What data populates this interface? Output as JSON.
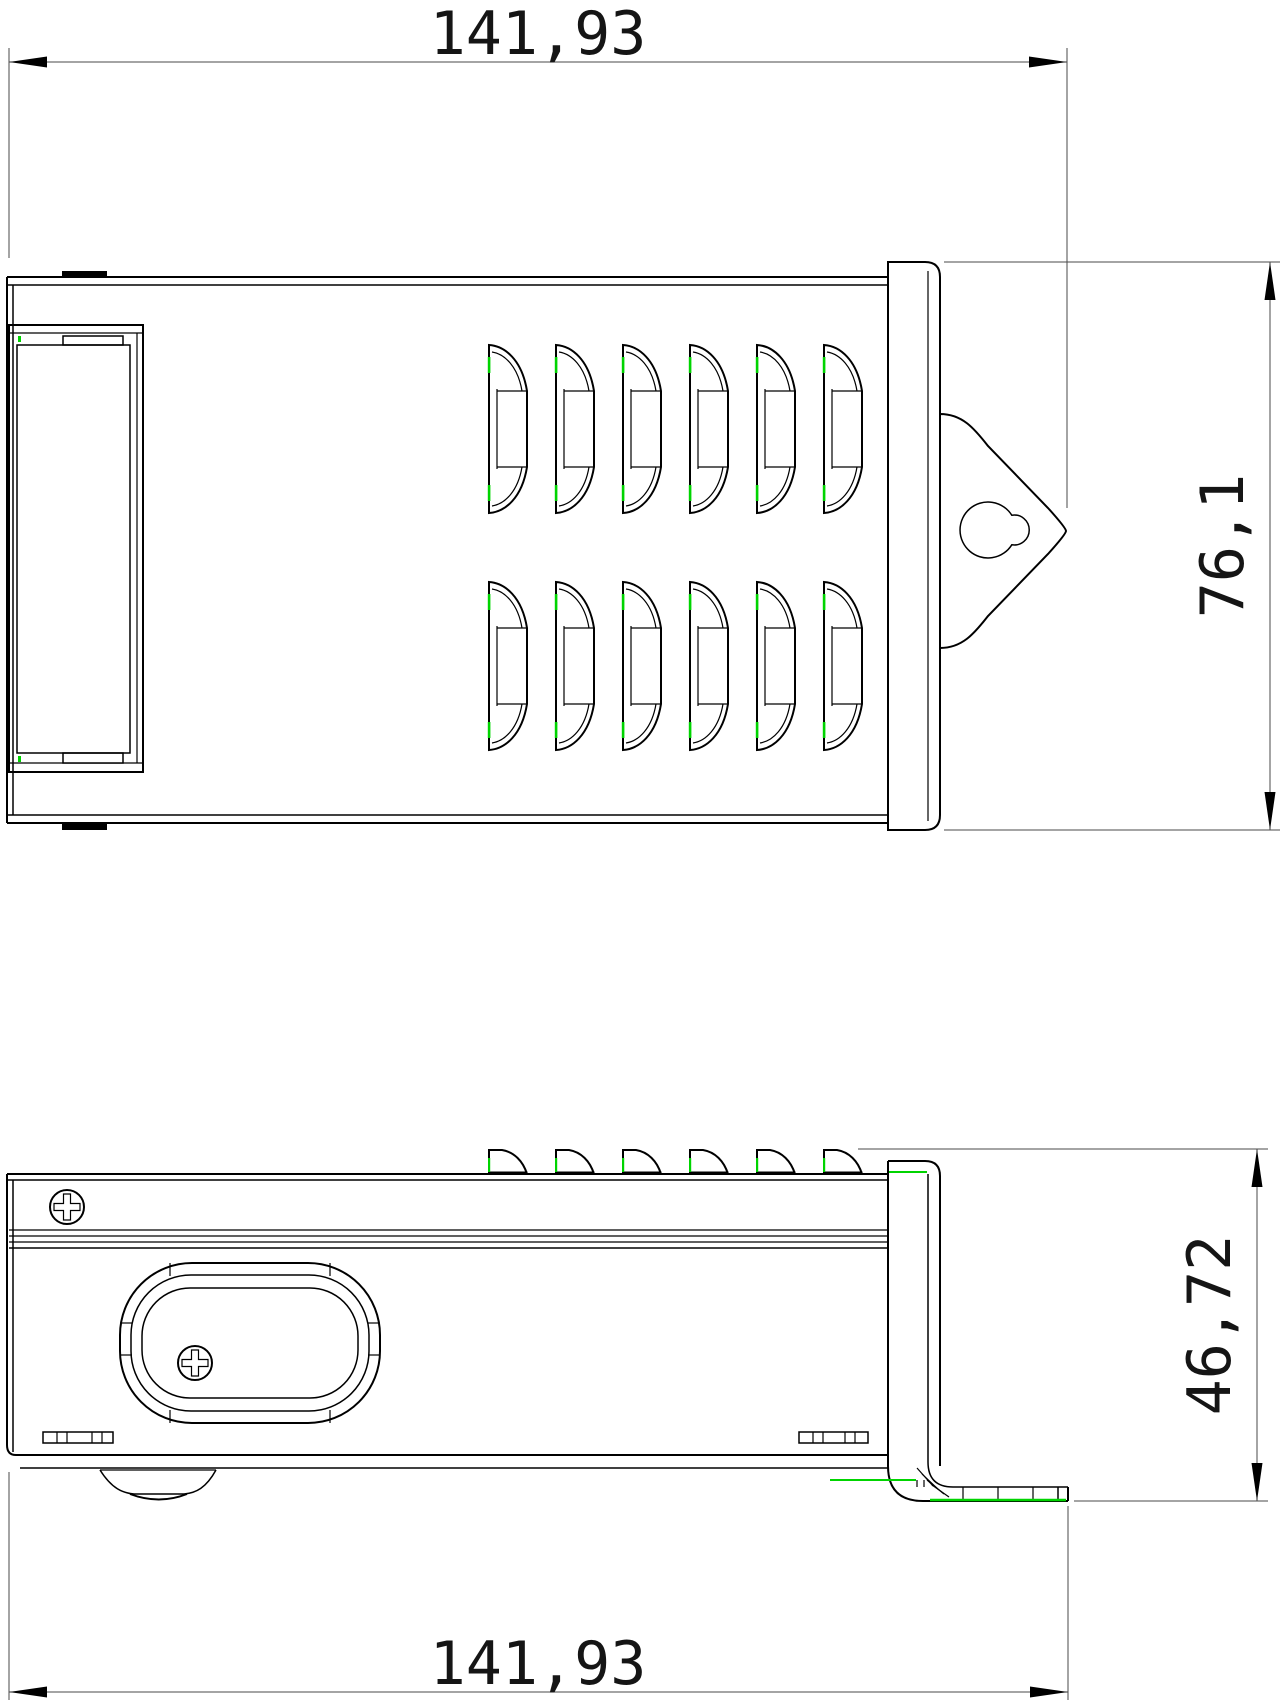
{
  "drawing": {
    "title": "enclosure-two-view-dimension-drawing",
    "dimensions": {
      "top_width": "141,93",
      "top_view_height": "76,1",
      "side_view_height": "46,72",
      "bottom_width": "141,93"
    },
    "units_style": "comma-decimal"
  },
  "icons": {
    "phillips_screw": "circle-with-cross-slot",
    "keyhole_slot": "circle-with-side-lobe",
    "dimension_arrow": "slender-filled-triangle"
  },
  "colors": {
    "line": "#000000",
    "dimension_line": "#4a4a4a",
    "highlight_green": "#00d400",
    "background": "#ffffff",
    "text": "#151515"
  }
}
